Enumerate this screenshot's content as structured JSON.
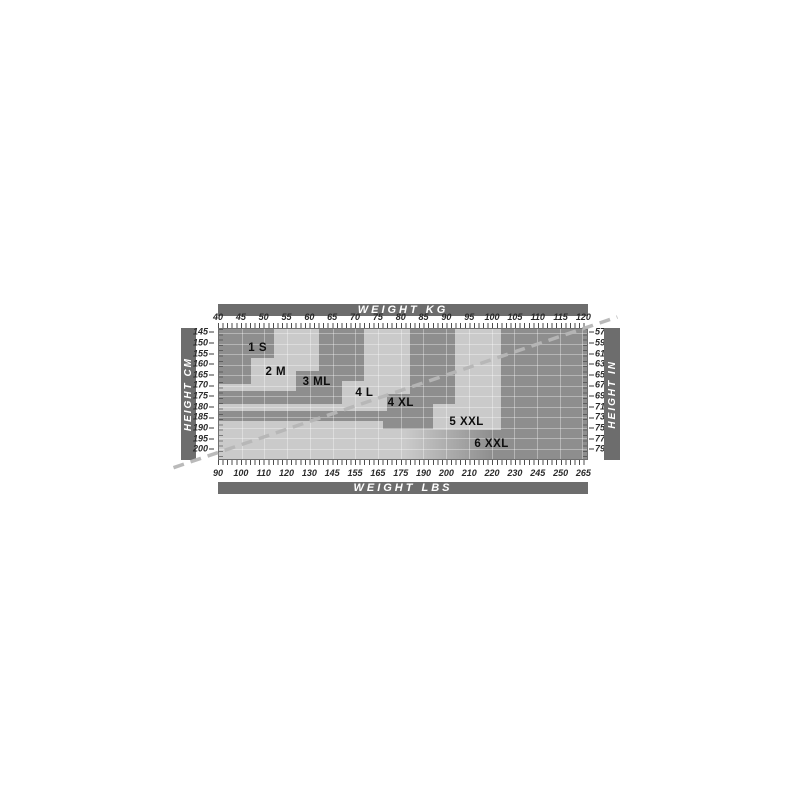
{
  "chart_data": {
    "type": "area",
    "description": "Garment size chart: stepped size regions over weight (kg/lbs) and height (cm/in) grid",
    "axes": {
      "top": {
        "label": "WEIGHT KG",
        "ticks": [
          40,
          45,
          50,
          55,
          60,
          65,
          70,
          75,
          80,
          85,
          90,
          95,
          100,
          105,
          110,
          115,
          120
        ]
      },
      "bottom": {
        "label": "WEIGHT LBS",
        "ticks": [
          90,
          100,
          110,
          120,
          130,
          145,
          155,
          165,
          175,
          190,
          200,
          210,
          220,
          230,
          245,
          250,
          265
        ]
      },
      "left": {
        "label": "HEIGHT CM",
        "ticks": [
          145,
          150,
          155,
          160,
          165,
          170,
          175,
          180,
          185,
          190,
          195,
          200
        ]
      },
      "right": {
        "label": "HEIGHT IN",
        "ticks": [
          57,
          59,
          61,
          63,
          65,
          67,
          69,
          71,
          73,
          75,
          77,
          79
        ]
      }
    },
    "kg_range": [
      40,
      121
    ],
    "cm_range": [
      143,
      205
    ],
    "grid": {
      "kg_lines": [
        45,
        50,
        55,
        60,
        65,
        70,
        75,
        80,
        85,
        90,
        95,
        100,
        105,
        110,
        115,
        120
      ],
      "cm_lines": [
        145,
        150,
        155,
        160,
        165,
        170,
        175,
        180,
        185,
        190,
        195,
        200
      ]
    },
    "sizes": [
      {
        "id": "1s",
        "label": "1 S",
        "shade": "dark",
        "label_kg": 48.5,
        "label_cm": 152,
        "rects": [
          [
            40,
            52,
            143,
            157
          ],
          [
            40,
            47,
            157,
            169
          ]
        ]
      },
      {
        "id": "2m",
        "label": "2 M",
        "shade": "light",
        "label_kg": 52.5,
        "label_cm": 163.5,
        "rects": [
          [
            52,
            62,
            143,
            157
          ],
          [
            47,
            62,
            157,
            163
          ],
          [
            47,
            57,
            163,
            169
          ],
          [
            40,
            57,
            169,
            172.5
          ]
        ]
      },
      {
        "id": "3ml",
        "label": "3 ML",
        "shade": "dark",
        "label_kg": 61.5,
        "label_cm": 168.5,
        "rects": [
          [
            62,
            72,
            143,
            163
          ],
          [
            57,
            72,
            163,
            168
          ],
          [
            57,
            67,
            168,
            172.5
          ],
          [
            40,
            67,
            172.5,
            179
          ]
        ]
      },
      {
        "id": "4l",
        "label": "4 L",
        "shade": "light",
        "label_kg": 72,
        "label_cm": 173.3,
        "rects": [
          [
            72,
            82,
            143,
            168
          ],
          [
            67,
            82,
            168,
            174
          ],
          [
            67,
            77,
            174,
            179
          ],
          [
            40,
            77,
            179,
            182
          ]
        ]
      },
      {
        "id": "4xl",
        "label": "4 XL",
        "shade": "dark",
        "label_kg": 80,
        "label_cm": 178.5,
        "rects": [
          [
            82,
            92,
            143,
            174
          ],
          [
            77,
            92,
            174,
            179
          ],
          [
            77,
            87,
            179,
            182
          ],
          [
            40,
            87,
            182,
            187
          ],
          [
            76,
            87,
            187,
            190.5
          ]
        ]
      },
      {
        "id": "5xxl",
        "label": "5 XXL",
        "shade": "light",
        "label_kg": 94.5,
        "label_cm": 187.5,
        "rects": [
          [
            92,
            102,
            143,
            179
          ],
          [
            87,
            102,
            179,
            187
          ],
          [
            40,
            102,
            187,
            191
          ]
        ]
      },
      {
        "id": "6xxl",
        "label": "6 XXL",
        "shade": "dark",
        "label_kg": 100,
        "label_cm": 198,
        "rects": [
          [
            102,
            121,
            143,
            205
          ]
        ]
      }
    ],
    "gradient_region": [
      40,
      102,
      191,
      205
    ],
    "reference_line": {
      "kg_from": 40,
      "cm_from": 201.5,
      "kg_to": 121,
      "cm_to": 142.5,
      "extends_beyond_plot": true
    },
    "colors": {
      "axis_bar": "#6d6d6d",
      "band_dark": "#8e8e8e",
      "band_light": "#cacaca",
      "grid_line": "rgba(255,255,255,0.35)",
      "dashed_line": "#b7b7b7",
      "size_label": "#0d0d0d",
      "tick_text": "#2a2a2a",
      "bar_text": "#ffffff",
      "page_bg": "#ffffff"
    }
  }
}
